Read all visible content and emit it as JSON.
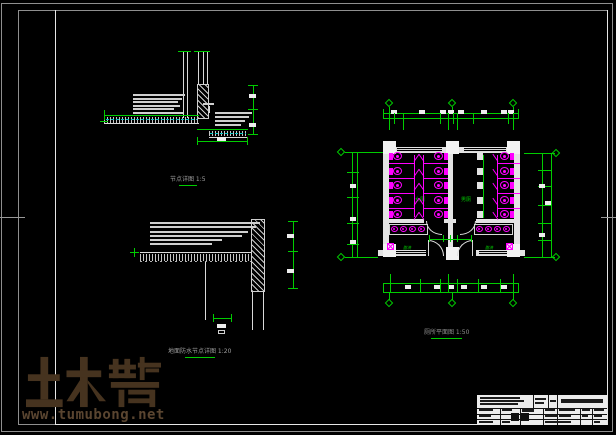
{
  "watermark": {
    "logo_text": "土木帮",
    "url": "www.tumubong.net"
  },
  "titles": {
    "detail1": "节点详图 1:5",
    "detail2": "地面防水节点详图 1:20",
    "plan": "厕所平面图 1:50"
  },
  "plan": {
    "room_labels": {
      "left": "女厕",
      "right": "男厕"
    },
    "wash_labels": {
      "left": "盥洗",
      "right": "盥洗"
    },
    "fixtures": {
      "stalls_per_bank": 5,
      "stall_banks": 3,
      "urinals": 5,
      "sink_counters": 2,
      "sinks_per_counter": 4,
      "floor_drains": 2
    }
  },
  "colors": {
    "background": "#000000",
    "line_green": "#00cc00",
    "fixture_magenta": "#ff00ff",
    "detail_white": "#d9d9d9",
    "waterproof_cyan": "#00c4c4",
    "frame_gray": "#999999",
    "watermark_brown": "#46331f"
  }
}
